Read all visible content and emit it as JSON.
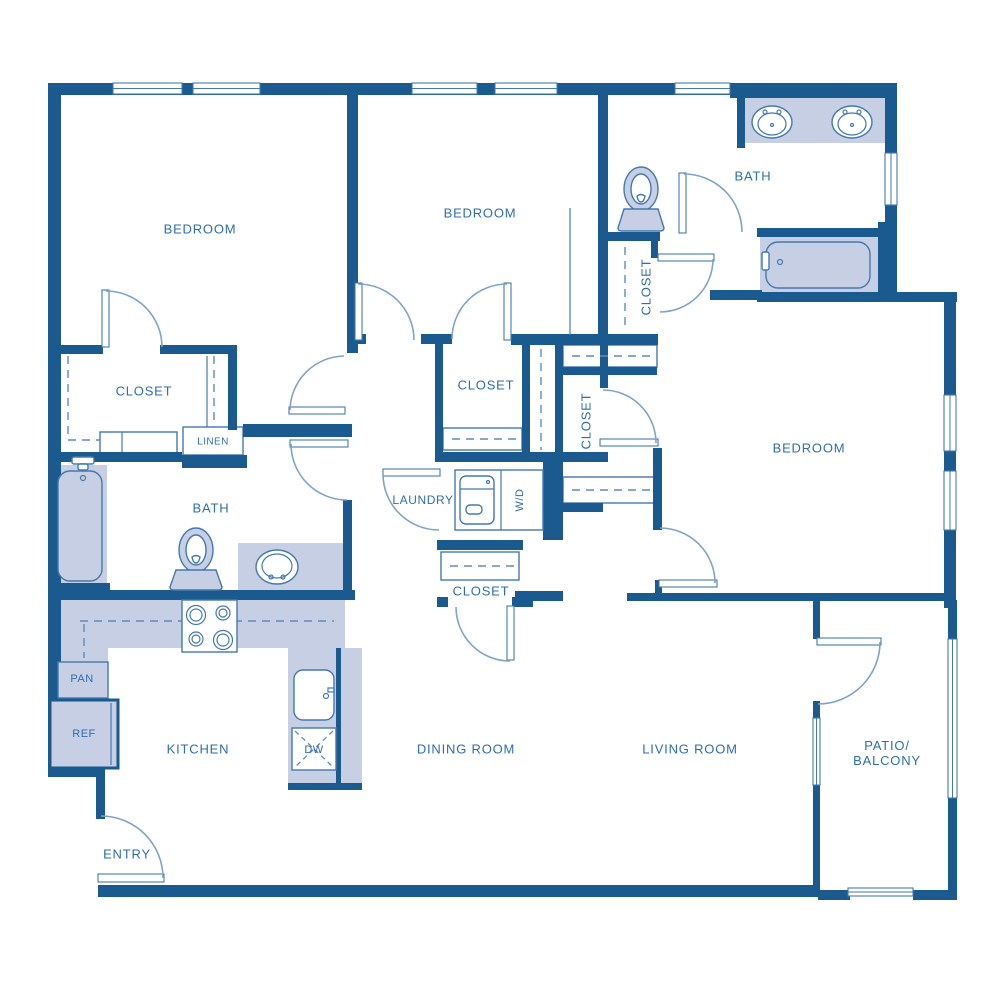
{
  "plan": {
    "labels": {
      "bedroom_top_left": "BEDROOM",
      "bedroom_top_middle": "BEDROOM",
      "bedroom_right": "BEDROOM",
      "bath_top": "BATH",
      "bath_left": "BATH",
      "closet_top_left": "CLOSET",
      "closet_middle": "CLOSET",
      "closet_hall_vertical": "CLOSET",
      "closet_toilet_vertical": "CLOSET",
      "closet_dining": "CLOSET",
      "linen": "LINEN",
      "laundry": "LAUNDRY",
      "washer_dryer": "W/D",
      "pantry": "PAN",
      "refrigerator": "REF",
      "kitchen": "KITCHEN",
      "dishwasher": "DW",
      "dining_room": "DINING ROOM",
      "living_room": "LIVING ROOM",
      "patio_line1": "PATIO/",
      "patio_line2": "BALCONY",
      "entry": "ENTRY"
    },
    "colors": {
      "wall": "#1a5a8e",
      "fixture_fill": "#c6cfe3",
      "outline": "#4579ae",
      "door_arc": "#7fa3c9",
      "label_text": "#2f6eae",
      "background": "#ffffff"
    }
  }
}
